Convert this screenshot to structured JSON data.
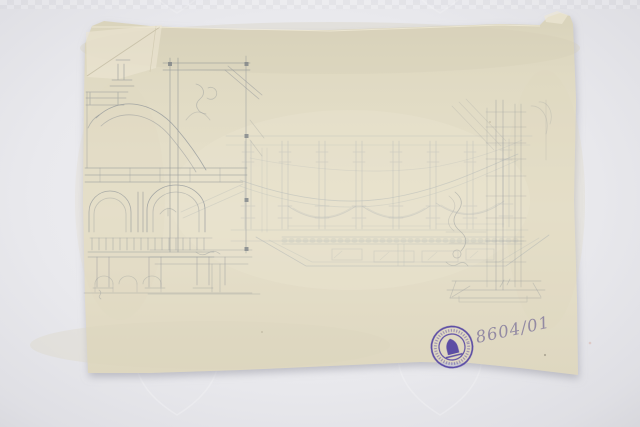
{
  "photo": {
    "background_color": "#e9e9ee",
    "paper_color": "#e3dcc5",
    "pencil_color": "#878d93",
    "watermark": "shield-watermark-pattern"
  },
  "sheet": {
    "content": "architectural-pencil-sketches",
    "left_sketch": "dome-section-with-arches",
    "center_sketch": "gallery-plan-with-piers-and-trapezoid-platform",
    "right_sketch": "vertical-pier-detail",
    "condition": "torn-folded-top-left-corner"
  },
  "stamp": {
    "shape": "circular",
    "color": "#4c3ba1",
    "emblem": "pointed-arch-emblem",
    "ring_text_legible": false
  },
  "inscription": {
    "number": "8604/01",
    "ink_color": "#8f86a2"
  }
}
